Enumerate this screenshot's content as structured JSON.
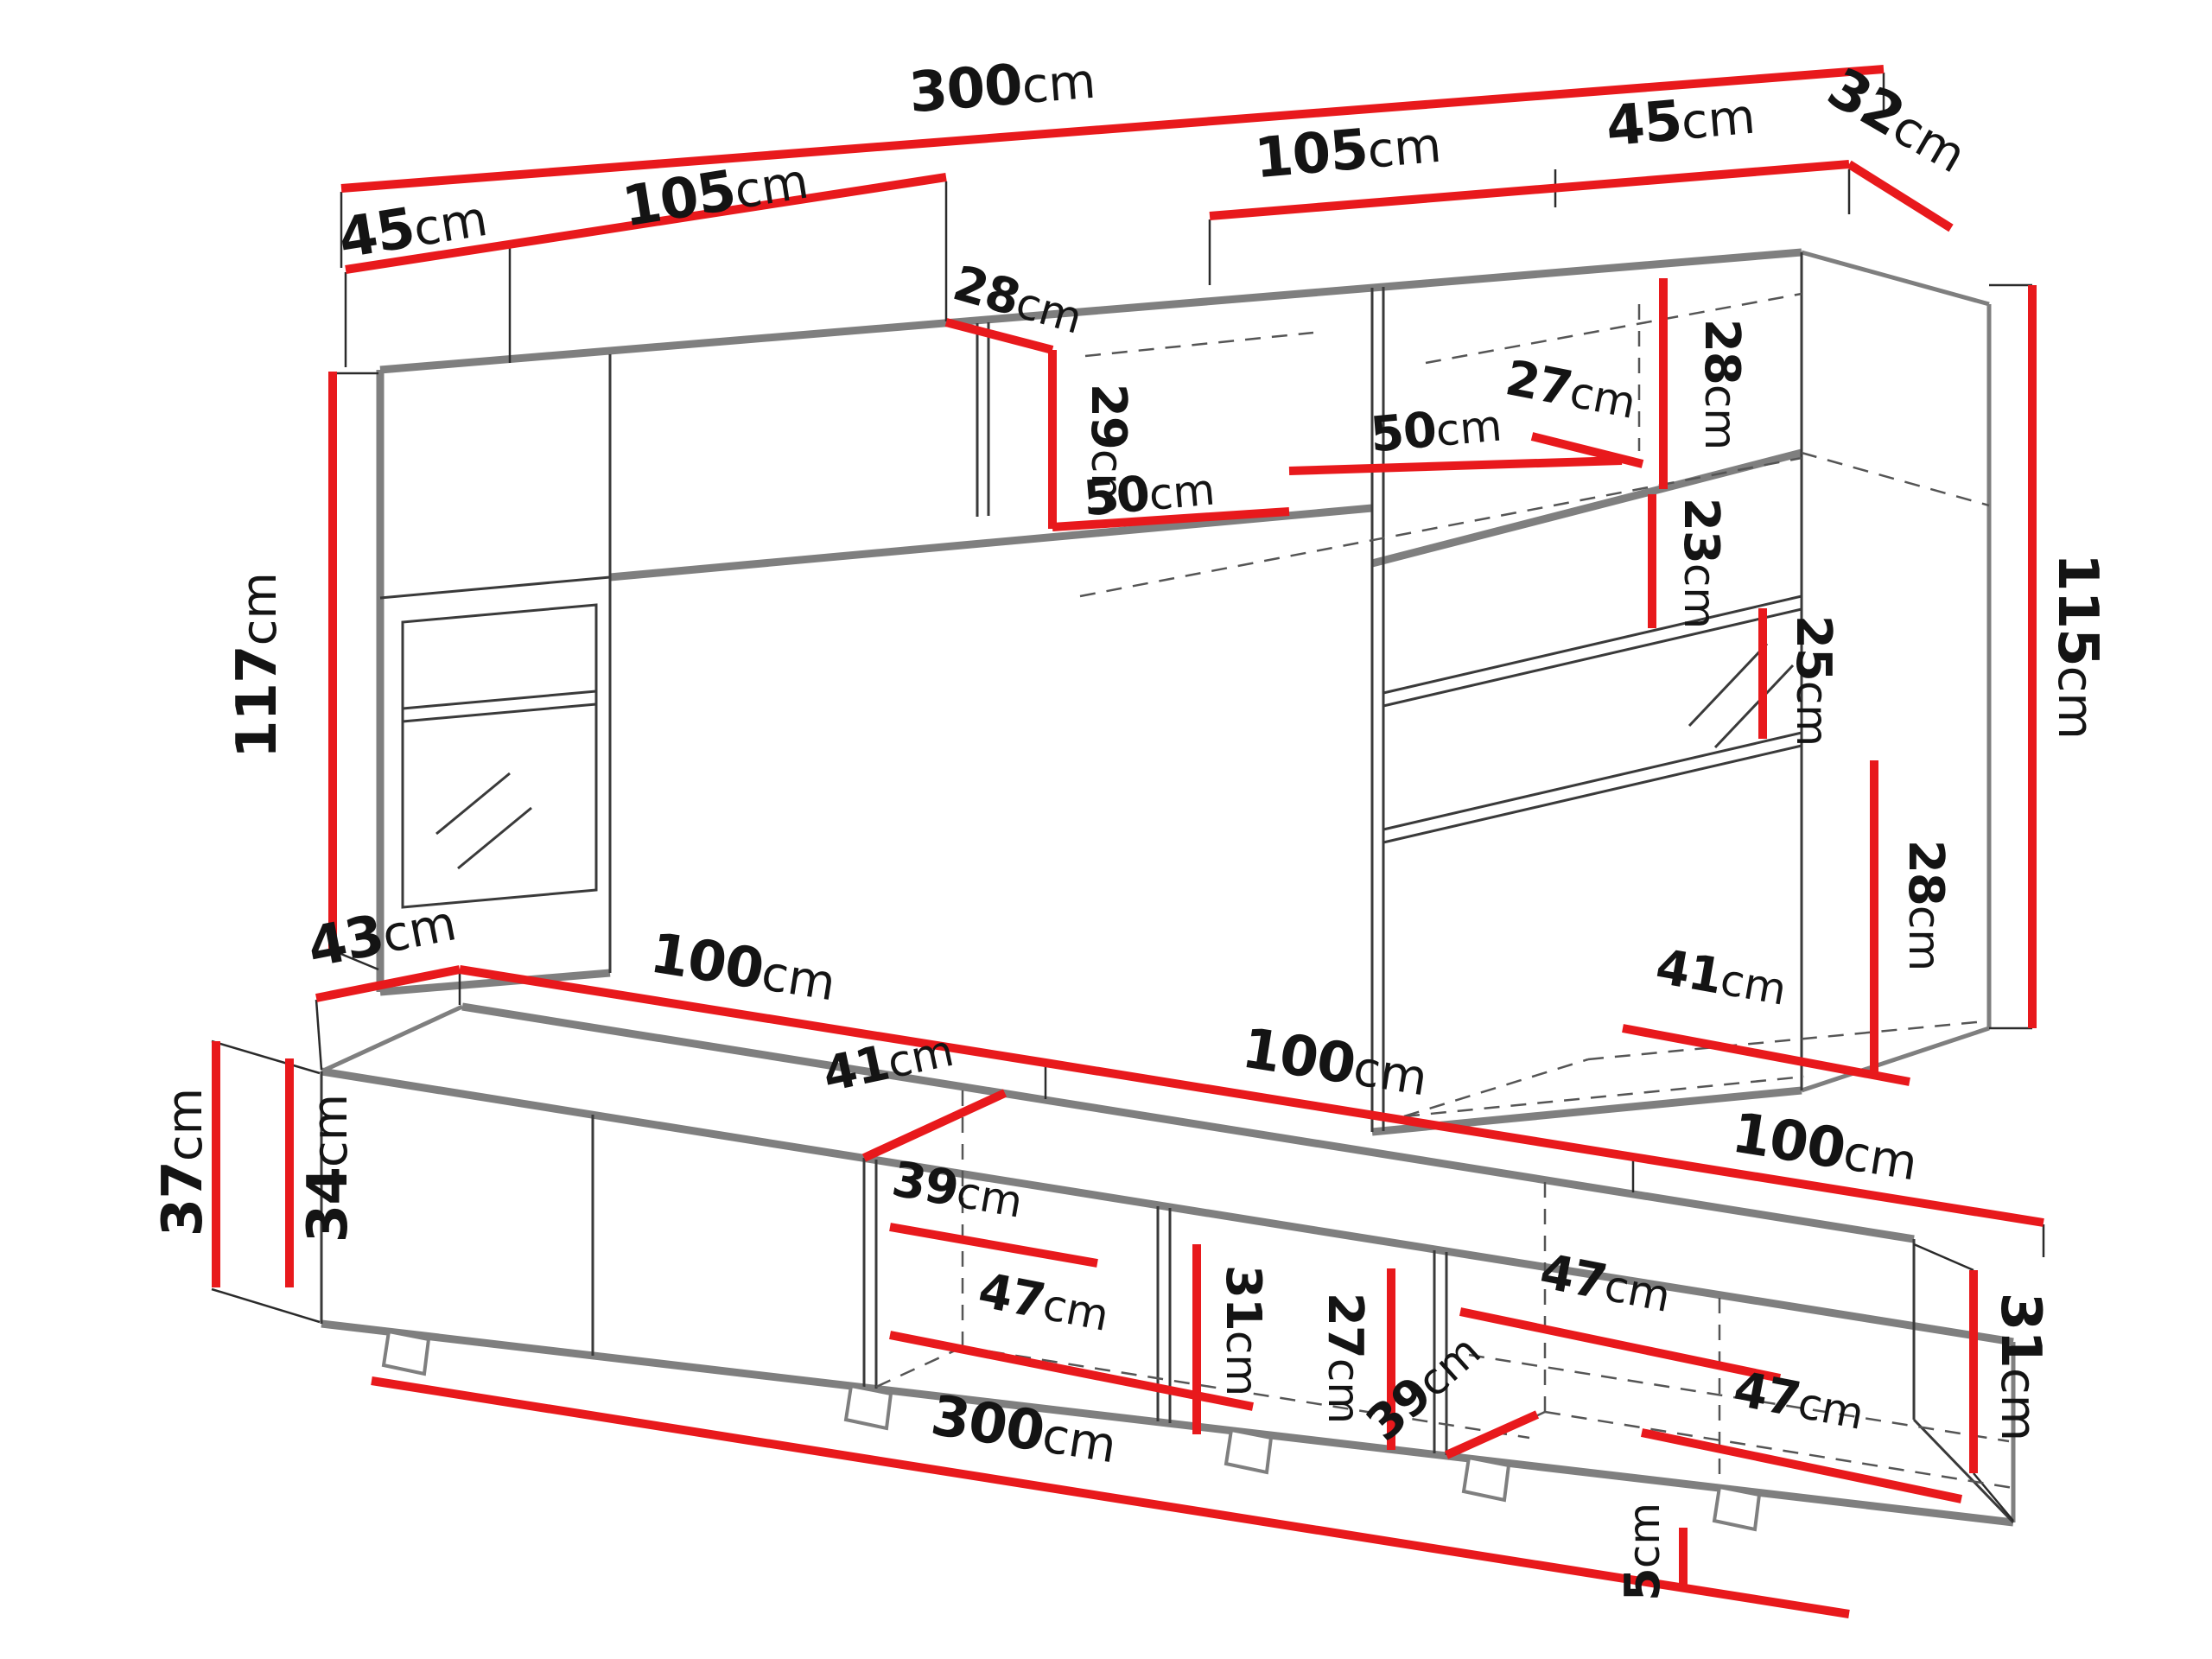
{
  "diagram": {
    "type": "furniture-dimension-drawing",
    "views": [
      "wall-unit-top-view",
      "tv-stand-bottom-view"
    ]
  },
  "colors": {
    "background": "#ffffff",
    "dimension_red": "#e8191c",
    "furniture_gray": "#7f7f7f",
    "line_dark": "#3a3a3a",
    "text_black": "#141414"
  },
  "dims": {
    "top": [
      {
        "name": "overall-width",
        "num": "300",
        "unit": "cm"
      },
      {
        "name": "left-side-depth",
        "num": "45",
        "unit": "cm"
      },
      {
        "name": "left-wall-cabinet-width",
        "num": "105",
        "unit": "cm"
      },
      {
        "name": "right-wall-cabinet-width",
        "num": "105",
        "unit": "cm"
      },
      {
        "name": "right-side-width",
        "num": "45",
        "unit": "cm"
      },
      {
        "name": "corner-return-depth",
        "num": "32",
        "unit": "cm"
      },
      {
        "name": "left-column-height",
        "num": "117",
        "unit": "cm"
      },
      {
        "name": "wall-cabinet-depth",
        "num": "28",
        "unit": "cm"
      },
      {
        "name": "wall-cabinet-height",
        "num": "29",
        "unit": "cm"
      },
      {
        "name": "niche-width-left",
        "num": "50",
        "unit": "cm"
      },
      {
        "name": "niche-width-right",
        "num": "50",
        "unit": "cm"
      },
      {
        "name": "upper-shelf-depth",
        "num": "27",
        "unit": "cm"
      },
      {
        "name": "top-compartment-height",
        "num": "28",
        "unit": "cm"
      },
      {
        "name": "shelf-spacing-upper",
        "num": "23",
        "unit": "cm"
      },
      {
        "name": "shelf-spacing-middle",
        "num": "25",
        "unit": "cm"
      },
      {
        "name": "shelf-spacing-lower",
        "num": "28",
        "unit": "cm"
      },
      {
        "name": "bottom-shelf-width",
        "num": "41",
        "unit": "cm"
      },
      {
        "name": "right-column-height",
        "num": "115",
        "unit": "cm"
      }
    ],
    "bottom": [
      {
        "name": "tv-stand-depth",
        "num": "43",
        "unit": "cm"
      },
      {
        "name": "tv-stand-1-width",
        "num": "100",
        "unit": "cm"
      },
      {
        "name": "tv-stand-2-width",
        "num": "100",
        "unit": "cm"
      },
      {
        "name": "tv-stand-3-width",
        "num": "100",
        "unit": "cm"
      },
      {
        "name": "height-with-feet",
        "num": "37",
        "unit": "cm"
      },
      {
        "name": "body-height",
        "num": "34",
        "unit": "cm"
      },
      {
        "name": "top-panel-depth",
        "num": "41",
        "unit": "cm"
      },
      {
        "name": "shelf-depth-left",
        "num": "39",
        "unit": "cm"
      },
      {
        "name": "compartment-width-left",
        "num": "47",
        "unit": "cm"
      },
      {
        "name": "compartment-height",
        "num": "31",
        "unit": "cm"
      },
      {
        "name": "compartment-inner-height",
        "num": "27",
        "unit": "cm"
      },
      {
        "name": "shelf-depth-right",
        "num": "39",
        "unit": "cm"
      },
      {
        "name": "compartment-width-middle",
        "num": "47",
        "unit": "cm"
      },
      {
        "name": "compartment-width-right",
        "num": "47",
        "unit": "cm"
      },
      {
        "name": "right-end-height",
        "num": "31",
        "unit": "cm"
      },
      {
        "name": "foot-height",
        "num": "5",
        "unit": "cm"
      },
      {
        "name": "overall-length",
        "num": "300",
        "unit": "cm"
      }
    ]
  }
}
